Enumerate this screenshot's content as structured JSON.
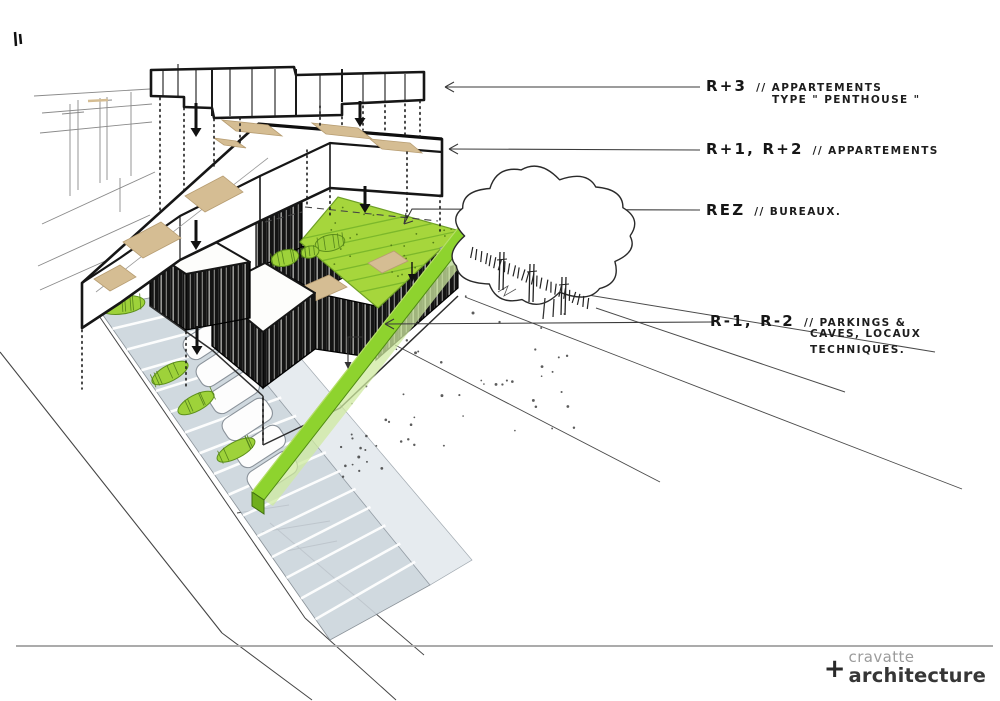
{
  "document": {
    "kind": "architectural concept sketch",
    "view": "exploded axonometric building levels"
  },
  "annotations": {
    "levels": [
      {
        "code": "R+3",
        "desc": "// APPARTEMENTS",
        "desc2": "TYPE \" PENTHOUSE \""
      },
      {
        "code": "R+1, R+2",
        "desc": "// APPARTEMENTS"
      },
      {
        "code": "REZ",
        "desc": "// BUREAUX."
      },
      {
        "code": "R-1, R-2",
        "desc": "// PARKINGS &",
        "desc2": "CAVES, LOCAUX",
        "desc3": "TECHNIQUES."
      }
    ]
  },
  "logo": {
    "plus": "+",
    "line1": "cravatte",
    "line2": "architecture"
  },
  "colors": {
    "ink": "#1a1a1a",
    "thin_line": "#555555",
    "terrace_tan": "#d5bd93",
    "grass_roof": "#a6d63c",
    "green_strip": "#8ed32e",
    "bush_green": "#9ed23a",
    "parking_gray": "#ccd5dc",
    "wall_black": "#141414",
    "logo_gray": "#9b9b9b",
    "logo_dark": "#363636",
    "bottom_rule": "#ababab"
  }
}
